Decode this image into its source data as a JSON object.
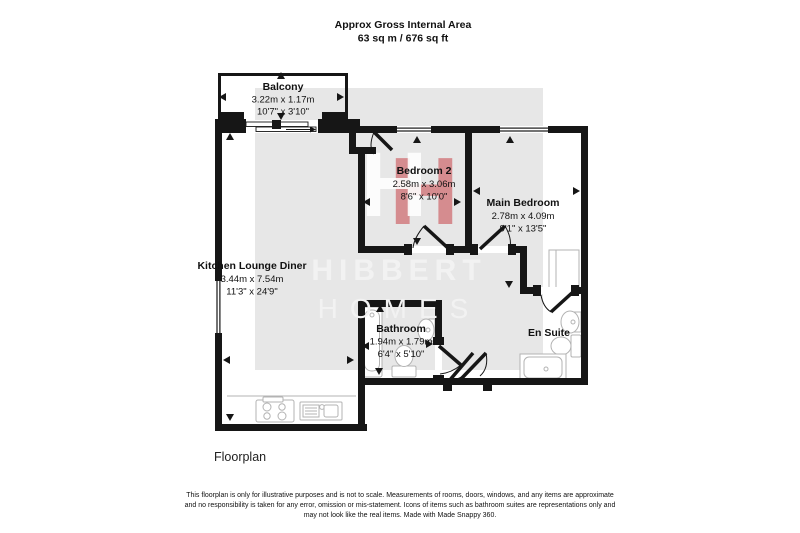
{
  "header": {
    "title": "Approx Gross Internal Area",
    "area": "63 sq m / 676 sq ft"
  },
  "rooms": {
    "balcony": {
      "name": "Balcony",
      "metric": "3.22m x 1.17m",
      "imperial": "10'7\" x 3'10\""
    },
    "kitchen_lounge_diner": {
      "name": "Kitchen Lounge Diner",
      "metric": "3.44m x 7.54m",
      "imperial": "11'3\" x 24'9\""
    },
    "bedroom_2": {
      "name": "Bedroom 2",
      "metric": "2.58m x 3.06m",
      "imperial": "8'6\" x 10'0\""
    },
    "main_bedroom": {
      "name": "Main Bedroom",
      "metric": "2.78m x 4.09m",
      "imperial": "9'1\" x 13'5\""
    },
    "bathroom": {
      "name": "Bathroom",
      "metric": "1.94m x 1.79m",
      "imperial": "6'4\" x 5'10\""
    },
    "en_suite": {
      "name": "En Suite"
    }
  },
  "watermark": {
    "logo_letter": "H",
    "brand_line1": "HIBBERT",
    "brand_line2": "HOMES",
    "accent_color": "#c5343a"
  },
  "caption": "Floorplan",
  "footer": {
    "lines": [
      "This floorplan is only for illustrative purposes and is not to scale. Measurements of rooms, doors, windows, and any items are approximate",
      "and no responsibility is taken for any error, omission or mis-statement. Icons of items such as bathroom suites are representations only and",
      "may not look like the real items. Made with Made Snappy 360."
    ]
  },
  "colors": {
    "wall": "#161616",
    "fixture": "#b3b3b3",
    "watermark_text": "#f2f2f2"
  }
}
